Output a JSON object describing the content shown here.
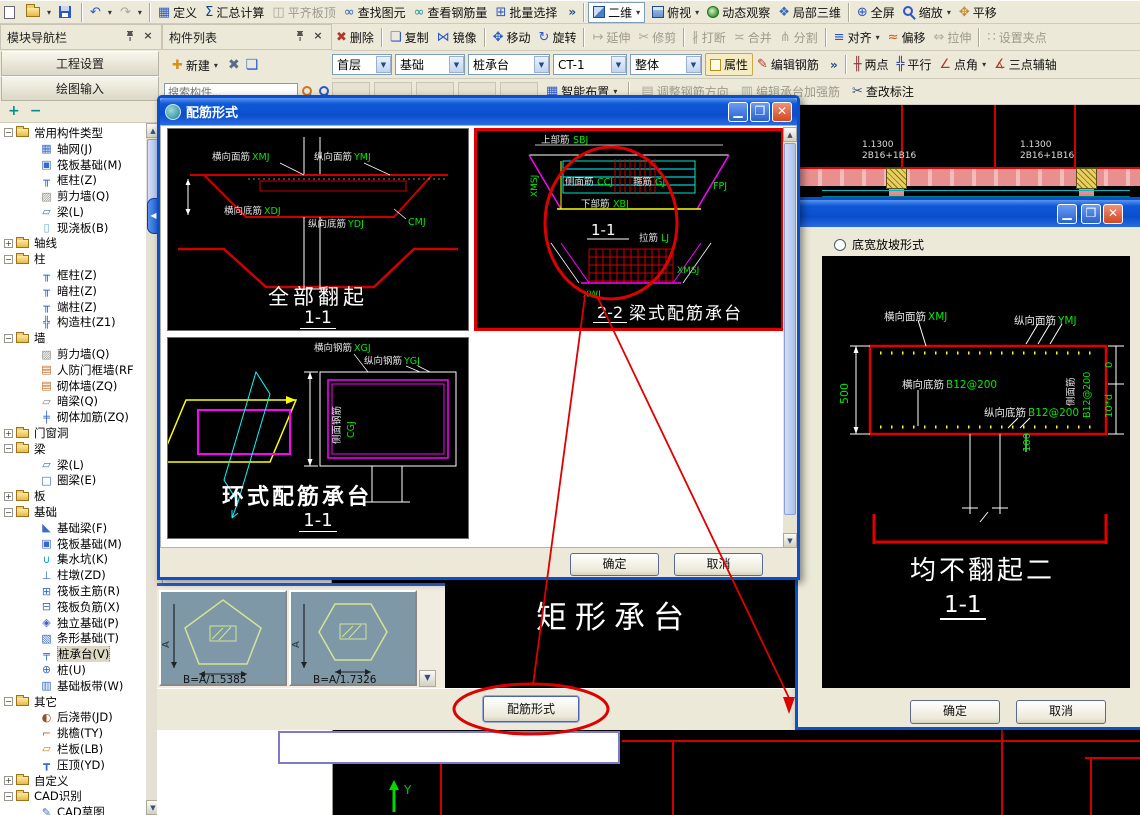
{
  "colors": {
    "accent": "#0a50cc",
    "cad_green": "#00e800",
    "cad_red": "#ff0000",
    "cad_magenta": "#ff00ff",
    "cad_cyan": "#00ffff",
    "cad_yellow": "#ffff00",
    "annotation_red": "#dd0000",
    "toolbar_bg": "#ece9d8"
  },
  "toolbar1": {
    "items": [
      {
        "name": "new-file-button",
        "iname": "new-file-icon",
        "ic": "pg",
        "label": "",
        "inter": true
      },
      {
        "name": "open-file-button",
        "iname": "open-folder-icon",
        "ic": "fold",
        "label": "",
        "cls": "dd",
        "inter": true
      },
      {
        "name": "save-button",
        "iname": "save-disk-icon",
        "ic": "disk",
        "label": "",
        "inter": true
      },
      {
        "cls": "sep",
        "inter": false
      },
      {
        "name": "undo-button",
        "iname": "undo-icon",
        "glyph": "↶",
        "gcolor": "#2a58c8",
        "label": "",
        "cls": "dd",
        "inter": true
      },
      {
        "name": "redo-button",
        "iname": "redo-icon",
        "glyph": "↷",
        "gcolor": "#9a9a90",
        "label": "",
        "cls": "dd dis",
        "inter": true
      },
      {
        "cls": "sep",
        "inter": false
      },
      {
        "name": "define-button",
        "iname": "define-table-icon",
        "glyph": "▦",
        "gcolor": "#2a58c8",
        "label": "定义",
        "inter": true
      },
      {
        "name": "summary-calc-button",
        "iname": "sigma-icon",
        "glyph": "Σ",
        "gcolor": "#15408a",
        "label": "汇总计算",
        "inter": true
      },
      {
        "name": "align-slab-top-button",
        "iname": "slab-top-icon",
        "glyph": "◫",
        "gcolor": "#aaa89a",
        "label": "平齐板顶",
        "cls": "dis",
        "inter": true
      },
      {
        "name": "find-element-button",
        "iname": "binoculars-icon",
        "glyph": "∞",
        "gcolor": "#2a58c8",
        "label": "查找图元",
        "inter": true
      },
      {
        "name": "view-rebar-qty-button",
        "iname": "glasses-icon",
        "glyph": "∞",
        "gcolor": "#1a8a9a",
        "label": "查看钢筋量",
        "inter": true
      },
      {
        "name": "batch-select-button",
        "iname": "batch-select-icon",
        "glyph": "⊞",
        "gcolor": "#2a58c8",
        "label": "批量选择",
        "inter": true
      },
      {
        "name": "toolbar1-overflow",
        "label": "»",
        "cls": "chev",
        "inter": true
      },
      {
        "cls": "sep",
        "inter": false
      },
      {
        "name": "view-mode-select",
        "iname": "2d-square-icon",
        "ic": "sq2d",
        "label": "二维",
        "cls": "combo dd",
        "inter": true
      },
      {
        "name": "top-view-button",
        "iname": "cube-icon",
        "ic": "cube",
        "label": "俯视",
        "cls": "dd",
        "inter": true
      },
      {
        "name": "orbit-button",
        "iname": "orbit-sphere-icon",
        "ic": "orb",
        "label": "动态观察",
        "inter": true
      },
      {
        "name": "local-3d-button",
        "iname": "local-3d-icon",
        "glyph": "❖",
        "gcolor": "#3a6ab8",
        "label": "局部三维",
        "inter": true
      },
      {
        "cls": "sep",
        "inter": false
      },
      {
        "name": "full-screen-button",
        "iname": "full-screen-icon",
        "glyph": "⊕",
        "gcolor": "#2a58c8",
        "label": "全屏",
        "inter": true
      },
      {
        "name": "zoom-button",
        "iname": "zoom-magnifier-icon",
        "ic": "mag",
        "label": "缩放",
        "cls": "dd",
        "inter": true
      },
      {
        "name": "pan-button",
        "iname": "pan-hand-icon",
        "glyph": "✥",
        "gcolor": "#c08a30",
        "label": "平移",
        "inter": true
      }
    ]
  },
  "toolbar2": {
    "items": [
      {
        "name": "delete-button",
        "iname": "brush-delete-icon",
        "glyph": "✖",
        "gcolor": "#b03a2a",
        "label": "删除",
        "inter": true
      },
      {
        "cls": "sep",
        "inter": false
      },
      {
        "name": "copy-button",
        "iname": "copy-icon",
        "glyph": "❏",
        "gcolor": "#2a58c8",
        "label": "复制",
        "inter": true
      },
      {
        "name": "mirror-button",
        "iname": "mirror-icon",
        "glyph": "⋈",
        "gcolor": "#2a58c8",
        "label": "镜像",
        "inter": true
      },
      {
        "cls": "sep",
        "inter": false
      },
      {
        "name": "move-button",
        "iname": "move-cross-icon",
        "glyph": "✥",
        "gcolor": "#2a58c8",
        "label": "移动",
        "inter": true
      },
      {
        "name": "rotate-button",
        "iname": "rotate-icon",
        "glyph": "↻",
        "gcolor": "#2a58c8",
        "label": "旋转",
        "inter": true
      },
      {
        "cls": "sep",
        "inter": false
      },
      {
        "name": "extend-button",
        "iname": "extend-icon",
        "glyph": "↦",
        "label": "延伸",
        "cls": "dis",
        "inter": true
      },
      {
        "name": "trim-button",
        "iname": "trim-scissors-icon",
        "glyph": "✂",
        "label": "修剪",
        "cls": "dis",
        "inter": true
      },
      {
        "cls": "sep",
        "inter": false
      },
      {
        "name": "break-button",
        "iname": "break-icon",
        "glyph": "∦",
        "label": "打断",
        "cls": "dis",
        "inter": true
      },
      {
        "name": "merge-button",
        "iname": "merge-icon",
        "glyph": "≍",
        "label": "合并",
        "cls": "dis",
        "inter": true
      },
      {
        "name": "split-button",
        "iname": "split-icon",
        "glyph": "⋔",
        "label": "分割",
        "cls": "dis",
        "inter": true
      },
      {
        "cls": "sep",
        "inter": false
      },
      {
        "name": "align-button",
        "iname": "align-icon",
        "glyph": "≡",
        "gcolor": "#2a58c8",
        "label": "对齐",
        "cls": "dd",
        "inter": true
      },
      {
        "name": "offset-button",
        "iname": "offset-icon",
        "glyph": "≈",
        "gcolor": "#c05a20",
        "label": "偏移",
        "inter": true
      },
      {
        "name": "stretch-button",
        "iname": "stretch-icon",
        "glyph": "⇔",
        "label": "拉伸",
        "cls": "dis",
        "inter": true
      },
      {
        "cls": "sep",
        "inter": false
      },
      {
        "name": "set-grip-button",
        "iname": "grip-icon",
        "glyph": "∷",
        "label": "设置夹点",
        "cls": "dis",
        "inter": true
      }
    ]
  },
  "toolbar3": {
    "combos": [
      {
        "name": "floor-select",
        "value": "首层"
      },
      {
        "name": "group-select",
        "value": "基础"
      },
      {
        "name": "type-select",
        "value": "桩承台"
      },
      {
        "name": "element-select",
        "value": "CT-1"
      },
      {
        "name": "display-select",
        "value": "整体"
      }
    ],
    "items": [
      {
        "name": "attribute-button",
        "iname": "note-icon",
        "ic": "note",
        "label": "属性",
        "cls": "tog",
        "inter": true
      },
      {
        "name": "edit-rebar-button",
        "iname": "pen-icon",
        "glyph": "✎",
        "gcolor": "#b03a2a",
        "label": "编辑钢筋",
        "inter": true
      },
      {
        "name": "toolbar3-overflow",
        "label": "»",
        "cls": "chev",
        "inter": true
      },
      {
        "cls": "sep",
        "inter": false
      },
      {
        "name": "two-point-axis-button",
        "iname": "axis-two-point-icon",
        "glyph": "╫",
        "gcolor": "#8a3a3a",
        "label": "两点",
        "inter": true
      },
      {
        "name": "parallel-axis-button",
        "iname": "axis-parallel-icon",
        "glyph": "╬",
        "gcolor": "#3a4a9a",
        "label": "平行",
        "inter": true
      },
      {
        "name": "point-angle-axis-button",
        "iname": "axis-point-angle-icon",
        "glyph": "∠",
        "gcolor": "#b03a2a",
        "label": "点角",
        "cls": "dd",
        "inter": true
      },
      {
        "name": "three-point-aux-axis-button",
        "iname": "axis-three-point-icon",
        "glyph": "∡",
        "gcolor": "#b03a2a",
        "label": "三点辅轴",
        "inter": true
      }
    ]
  },
  "toolbar4": {
    "items": [
      {
        "name": "hidden-tool-1",
        "label": "",
        "cls": "ph dis",
        "inter": false
      },
      {
        "name": "hidden-tool-2",
        "label": "",
        "cls": "ph dis",
        "inter": false
      },
      {
        "name": "hidden-tool-3",
        "label": "",
        "cls": "ph dis",
        "inter": false
      },
      {
        "name": "hidden-tool-4",
        "label": "",
        "cls": "ph dis",
        "inter": false
      },
      {
        "name": "hidden-tool-5",
        "label": "",
        "cls": "ph dis",
        "inter": false
      },
      {
        "name": "smart-layout-button",
        "iname": "smart-layout-icon",
        "glyph": "▦",
        "gcolor": "#2a58c8",
        "label": "智能布置",
        "cls": "dd",
        "inter": true
      },
      {
        "cls": "sep",
        "inter": false
      },
      {
        "name": "adjust-rebar-direction-button",
        "iname": "adjust-direction-icon",
        "glyph": "▤",
        "label": "调整钢筋方向",
        "cls": "dis",
        "inter": true
      },
      {
        "name": "edit-cap-strengthen-rebar-button",
        "iname": "strengthen-rebar-icon",
        "glyph": "▥",
        "label": "编辑承台加强筋",
        "cls": "dis",
        "inter": true
      },
      {
        "name": "check-annotation-button",
        "iname": "check-annotation-icon",
        "glyph": "✂",
        "gcolor": "#40508a",
        "label": "查改标注",
        "inter": true
      }
    ]
  },
  "nav": {
    "title": "模块导航栏",
    "project_btn": "工程设置",
    "draw_btn": "绘图输入",
    "expand_all": "+",
    "collapse_all": "−",
    "tree": [
      {
        "exp": "−",
        "ic": "tfold",
        "label": "常用构件类型",
        "name": "tree-folder-common-types",
        "inter": true
      },
      {
        "exp": "",
        "glyph": "▦",
        "gcolor": "#3a68c8",
        "label": "轴网(J)",
        "cls": "lv1",
        "inter": true
      },
      {
        "exp": "",
        "glyph": "▣",
        "gcolor": "#3a68c8",
        "label": "筏板基础(M)",
        "cls": "lv1",
        "inter": true
      },
      {
        "exp": "",
        "glyph": "╥",
        "gcolor": "#3a68c8",
        "label": "框柱(Z)",
        "cls": "lv1",
        "inter": true
      },
      {
        "exp": "",
        "glyph": "▨",
        "gcolor": "#909088",
        "label": "剪力墙(Q)",
        "cls": "lv1",
        "inter": true
      },
      {
        "exp": "",
        "glyph": "▱",
        "gcolor": "#3a68c8",
        "label": "梁(L)",
        "cls": "lv1",
        "inter": true
      },
      {
        "exp": "",
        "glyph": "▯",
        "gcolor": "#68a8d8",
        "label": "现浇板(B)",
        "cls": "lv1",
        "inter": true
      },
      {
        "exp": "+",
        "ic": "tfold",
        "label": "轴线",
        "name": "tree-folder-axis",
        "inter": true
      },
      {
        "exp": "−",
        "ic": "tfold",
        "label": "柱",
        "name": "tree-folder-column",
        "inter": true
      },
      {
        "exp": "",
        "glyph": "╥",
        "gcolor": "#3a68c8",
        "label": "框柱(Z)",
        "cls": "lv1",
        "inter": true
      },
      {
        "exp": "",
        "glyph": "╥",
        "gcolor": "#3a68c8",
        "label": "暗柱(Z)",
        "cls": "lv1",
        "inter": true
      },
      {
        "exp": "",
        "glyph": "╥",
        "gcolor": "#3a68c8",
        "label": "端柱(Z)",
        "cls": "lv1",
        "inter": true
      },
      {
        "exp": "",
        "glyph": "╬",
        "gcolor": "#3a68c8",
        "label": "构造柱(Z1)",
        "cls": "lv1",
        "inter": true
      },
      {
        "exp": "−",
        "ic": "tfold",
        "label": "墙",
        "name": "tree-folder-wall",
        "inter": true
      },
      {
        "exp": "",
        "glyph": "▨",
        "gcolor": "#909088",
        "label": "剪力墙(Q)",
        "cls": "lv1",
        "inter": true
      },
      {
        "exp": "",
        "glyph": "▤",
        "gcolor": "#c06820",
        "label": "人防门框墙(RF",
        "cls": "lv1",
        "inter": true
      },
      {
        "exp": "",
        "glyph": "▤",
        "gcolor": "#c06820",
        "label": "砌体墙(ZQ)",
        "cls": "lv1",
        "inter": true
      },
      {
        "exp": "",
        "glyph": "▱",
        "gcolor": "#808890",
        "label": "暗梁(Q)",
        "cls": "lv1",
        "inter": true
      },
      {
        "exp": "",
        "glyph": "╪",
        "gcolor": "#3a68c8",
        "label": "砌体加筋(ZQ)",
        "cls": "lv1",
        "inter": true
      },
      {
        "exp": "+",
        "ic": "tfold",
        "label": "门窗洞",
        "name": "tree-folder-door-window",
        "inter": true
      },
      {
        "exp": "−",
        "ic": "tfold",
        "label": "梁",
        "name": "tree-folder-beam",
        "inter": true
      },
      {
        "exp": "",
        "glyph": "▱",
        "gcolor": "#3a68c8",
        "label": "梁(L)",
        "cls": "lv1",
        "inter": true
      },
      {
        "exp": "",
        "glyph": "□",
        "gcolor": "#3a68c8",
        "label": "圈梁(E)",
        "cls": "lv1",
        "inter": true
      },
      {
        "exp": "+",
        "ic": "tfold",
        "label": "板",
        "name": "tree-folder-slab",
        "inter": true
      },
      {
        "exp": "−",
        "ic": "tfold",
        "label": "基础",
        "name": "tree-folder-foundation",
        "inter": true
      },
      {
        "exp": "",
        "glyph": "◣",
        "gcolor": "#3a68c8",
        "label": "基础梁(F)",
        "cls": "lv1",
        "inter": true
      },
      {
        "exp": "",
        "glyph": "▣",
        "gcolor": "#3a68c8",
        "label": "筏板基础(M)",
        "cls": "lv1",
        "inter": true
      },
      {
        "exp": "",
        "glyph": "∪",
        "gcolor": "#18a0b8",
        "label": "集水坑(K)",
        "cls": "lv1",
        "inter": true
      },
      {
        "exp": "",
        "glyph": "⊥",
        "gcolor": "#3a68c8",
        "label": "柱墩(ZD)",
        "cls": "lv1",
        "inter": true
      },
      {
        "exp": "",
        "glyph": "⊞",
        "gcolor": "#3a68c8",
        "label": "筏板主筋(R)",
        "cls": "lv1",
        "inter": true
      },
      {
        "exp": "",
        "glyph": "⊟",
        "gcolor": "#3a68c8",
        "label": "筏板负筋(X)",
        "cls": "lv1",
        "inter": true
      },
      {
        "exp": "",
        "glyph": "◈",
        "gcolor": "#3a68c8",
        "label": "独立基础(P)",
        "cls": "lv1",
        "inter": true
      },
      {
        "exp": "",
        "glyph": "▧",
        "gcolor": "#3a68c8",
        "label": "条形基础(T)",
        "cls": "lv1",
        "inter": true
      },
      {
        "exp": "",
        "glyph": "╤",
        "gcolor": "#3a68c8",
        "label": "桩承台(V)",
        "cls": "lv1 sel",
        "name": "tree-item-pile-cap",
        "inter": true
      },
      {
        "exp": "",
        "glyph": "⊕",
        "gcolor": "#3a68c8",
        "label": "桩(U)",
        "cls": "lv1",
        "inter": true
      },
      {
        "exp": "",
        "glyph": "▥",
        "gcolor": "#3a68c8",
        "label": "基础板带(W)",
        "cls": "lv1",
        "inter": true
      },
      {
        "exp": "−",
        "ic": "tfold",
        "label": "其它",
        "name": "tree-folder-other",
        "inter": true
      },
      {
        "exp": "",
        "glyph": "◐",
        "gcolor": "#905030",
        "label": "后浇带(JD)",
        "cls": "lv1",
        "inter": true
      },
      {
        "exp": "",
        "glyph": "⌐",
        "gcolor": "#c06820",
        "label": "挑檐(TY)",
        "cls": "lv1",
        "inter": true
      },
      {
        "exp": "",
        "glyph": "▱",
        "gcolor": "#c08820",
        "label": "栏板(LB)",
        "cls": "lv1",
        "inter": true
      },
      {
        "exp": "",
        "glyph": "┳",
        "gcolor": "#3a68c8",
        "label": "压顶(YD)",
        "cls": "lv1",
        "inter": true
      },
      {
        "exp": "+",
        "ic": "tfold",
        "label": "自定义",
        "name": "tree-folder-custom",
        "inter": true
      },
      {
        "exp": "−",
        "ic": "tfold",
        "label": "CAD识别",
        "name": "tree-folder-cad",
        "inter": true
      },
      {
        "exp": "",
        "glyph": "✎",
        "gcolor": "#3a68c8",
        "label": "CAD草图",
        "cls": "lv1",
        "inter": true
      }
    ]
  },
  "components": {
    "title": "构件列表",
    "new_btn": "新建",
    "search_placeholder": "搜索构件..."
  },
  "dialog_peijin": {
    "title": "配筋形式",
    "ok": "确定",
    "cancel": "取消",
    "option1": {
      "caption": "全部翻起",
      "section": "1-1",
      "labels": {
        "top_x_cn": "横向面筋",
        "top_x_code": "XMJ",
        "top_y_cn": "纵向面筋",
        "top_y_code": "YMJ",
        "bot_x_cn": "横向底筋",
        "bot_x_code": "XDJ",
        "bot_y_cn": "纵向底筋",
        "bot_y_code": "YDJ",
        "corner_code": "CMJ"
      }
    },
    "option2": {
      "caption": "梁式配筋承台",
      "section": "2-2",
      "labels": {
        "top_cn": "上部筋",
        "top_code": "SBJ",
        "side_cn": "侧面筋",
        "side_code": "CCJ",
        "stirrup_cn": "箍筋",
        "stirrup_code": "GJ",
        "bottom_cn": "下部筋",
        "bottom_code": "XBJ",
        "tie_cn": "拉筋",
        "tie_code": "LJ",
        "sec_label": "1-1",
        "xmsj": "XMSJ",
        "xwj": "XWJ",
        "fpj": "FPJ"
      }
    },
    "option3": {
      "caption": "环式配筋承台",
      "section": "1-1",
      "labels": {
        "h_cn": "横向钢筋",
        "h_code": "XGJ",
        "v_cn": "纵向钢筋",
        "v_code": "YGJ",
        "s_cn": "侧面钢筋",
        "s_code": "CGJ"
      }
    }
  },
  "dialog_slope": {
    "radio": "底宽放坡形式",
    "caption": "均不翻起二",
    "section": "1-1",
    "ok": "确定",
    "cancel": "取消",
    "labels": {
      "top_x_cn": "横向面筋",
      "top_x_code": "XMJ",
      "top_y_cn": "纵向面筋",
      "top_y_code": "YMJ",
      "bot_x_cn": "横向底筋",
      "bot_x_code": "B12@200",
      "bot_y_cn": "纵向底筋",
      "bot_y_code": "B12@200",
      "side_cn": "侧面筋",
      "side_code": "B12@200",
      "dim_left": "500",
      "dim_right_top": "0",
      "dim_right_bottom": "10*d",
      "dim_bottom": "100"
    }
  },
  "canvas": {
    "rect_caption": "矩形承台",
    "peijin_btn": "配筋形式",
    "thumb1": "B=A/1.5385",
    "thumb2": "B=A/1.7326",
    "axis_y": "Y",
    "grid_label_a": "1.1300",
    "grid_label_b": "2B16+1B16"
  }
}
